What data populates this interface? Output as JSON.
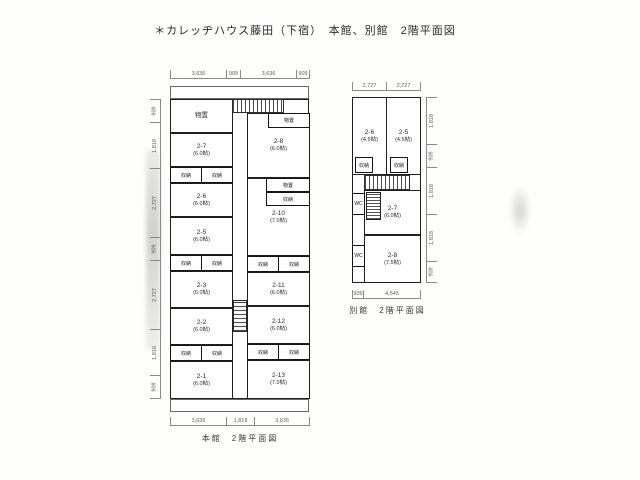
{
  "page": {
    "title": "＊カレッヂハウス藤田（下宿）　本館、別館　2階平面図"
  },
  "labels": {
    "closet": "収納",
    "storage": "物置",
    "wc": "WC"
  },
  "main_plan": {
    "caption": "本館　2階平面図",
    "rooms": [
      {
        "id": "2-7",
        "size": "(6.0帖)"
      },
      {
        "id": "2-6",
        "size": "(6.0帖)"
      },
      {
        "id": "2-5",
        "size": "(6.0帖)"
      },
      {
        "id": "2-3",
        "size": "(6.0帖)"
      },
      {
        "id": "2-2",
        "size": "(6.0帖)"
      },
      {
        "id": "2-1",
        "size": "(6.0帖)"
      },
      {
        "id": "2-8",
        "size": "(6.0帖)"
      },
      {
        "id": "2-10",
        "size": "(7.0帖)"
      },
      {
        "id": "2-11",
        "size": "(6.0帖)"
      },
      {
        "id": "2-12",
        "size": "(6.0帖)"
      },
      {
        "id": "2-13",
        "size": "(7.0帖)"
      }
    ],
    "dims_top": [
      "3,636",
      "909",
      "3,636",
      "909"
    ],
    "dims_bottom": [
      "3,636",
      "1,818",
      "3,636"
    ],
    "dims_left": [
      "909",
      "1,818",
      "2,727",
      "909",
      "2,727",
      "1,818",
      "909"
    ]
  },
  "annex_plan": {
    "caption": "別館　2階平面図",
    "rooms": [
      {
        "id": "2-6",
        "size": "(4.5帖)"
      },
      {
        "id": "2-5",
        "size": "(4.5帖)"
      },
      {
        "id": "2-7",
        "size": "(6.0帖)"
      },
      {
        "id": "2-8",
        "size": "(7.5帖)"
      }
    ],
    "dims_top": [
      "2,727",
      "2,727"
    ],
    "dims_bottom": [
      "909",
      "4,545"
    ],
    "dims_right": [
      "1,818",
      "909",
      "1,818",
      "1,818",
      "909"
    ]
  }
}
